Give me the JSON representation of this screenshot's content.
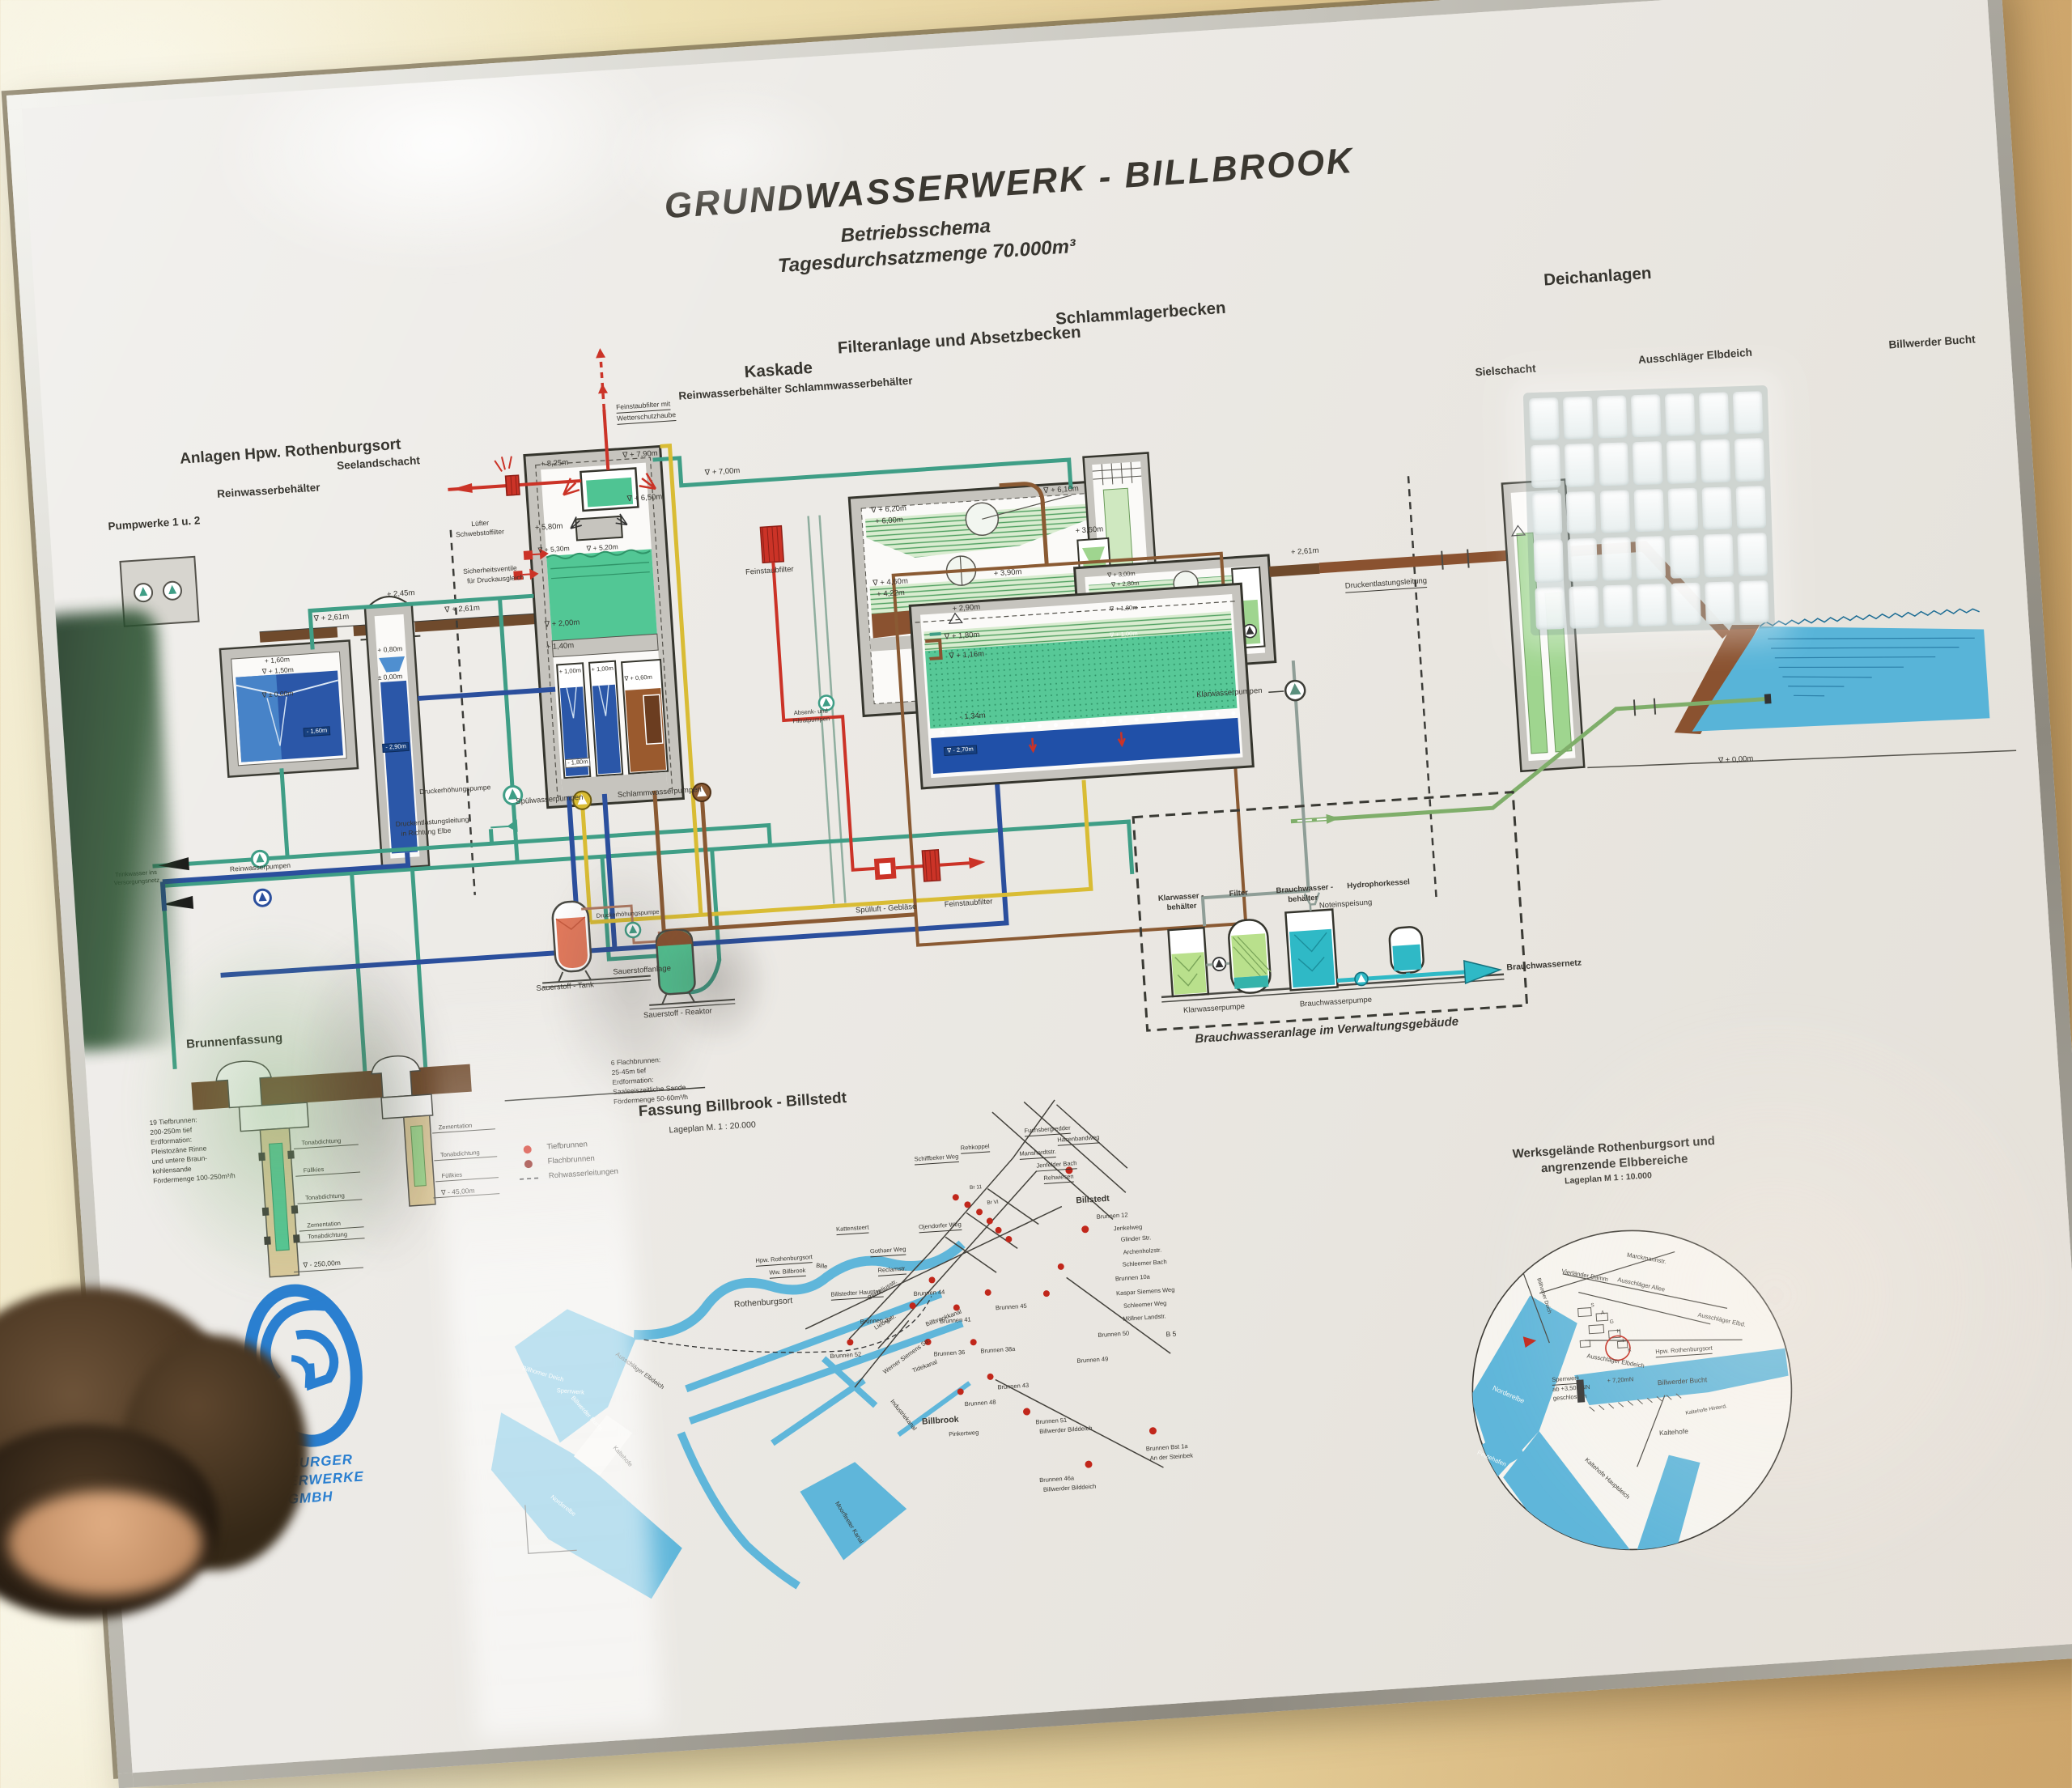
{
  "title": {
    "main": "GRUNDWASSERWERK - BILLBROOK",
    "sub1": "Betriebsschema",
    "sub2": "Tagesdurchsatzmenge 70.000m³"
  },
  "sections": {
    "anlagen": "Anlagen Hpw. Rothenburgsort",
    "pumpwerke": "Pumpwerke 1 u. 2",
    "reinwasser": "Reinwasserbehälter",
    "seeland": "Seelandschacht",
    "kaskade": "Kaskade",
    "kaskade_sub": "Reinwasserbehälter   Schlammwasserbehälter",
    "filteranlage": "Filteranlage und Absetzbecken",
    "schlamm": "Schlammlagerbecken",
    "deich": "Deichanlagen",
    "siel": "Sielschacht",
    "ausschlaeger": "Ausschläger Elbdeich",
    "billwerder": "Billwerder Bucht",
    "brunnen": "Brunnenfassung"
  },
  "labels": {
    "luefter": "Lüfter",
    "schwebstoff": "Schwebstoffilter",
    "feinstaub_mit": "Feinstaubfilter mit",
    "wetterschutz": "Wetterschutzhaube",
    "sicherheitsventile": "Sicherheitsventile",
    "druckausgleich": "für Druckausgleich",
    "feinstaubfilter": "Feinstaubfilter",
    "absenk": "Absenk- und",
    "filtratpumpen": "Filtratpumpen",
    "spuelwasserpumpen": "Spülwasserpumpen",
    "schlammwasserpumpen": "Schlammwasserpumpen",
    "druckerhoehung": "Druckerhöhungspumpe",
    "druckentlastung": "Druckentlastungsleitung",
    "richtung_elbe": "in Richtung Elbe",
    "trinkwasser1": "Trinkwasser ins",
    "trinkwasser2": "Versorgungsnetz",
    "reinwasserpumpen": "Reinwasserpumpen",
    "sauerstoff_tank": "Sauerstoff - Tank",
    "sauerstoffanlage": "Sauerstoffanlage",
    "sauerstoff_reaktor": "Sauerstoff - Reaktor",
    "spuelluft": "Spülluft - Gebläse",
    "klarwasserpumpen": "Klarwasserpumpen"
  },
  "levels": {
    "l825": "+ 8,25m",
    "l790": "∇ + 7,90m",
    "l700": "∇ + 7,00m",
    "l650": "∇ + 6,50m",
    "l580": "+ 5,80m",
    "l530": "∇ + 5,30m",
    "l520": "∇ + 5,20m",
    "l200": "∇ + 2,00m",
    "l140": "+ 1,40m",
    "l100a": "+ 1,00m",
    "l100b": "+ 1,00m",
    "l060": "∇ + 0,60m",
    "lm180": "- 1,80m",
    "l620": "∇ + 6,20m",
    "l600": "+ 6,00m",
    "l460": "∇ + 4,60m",
    "l422": "+ 4,22m",
    "l390": "+ 3,90m",
    "l610": "∇ + 6,10m",
    "l290": "+ 2,90m",
    "l180": "∇ + 1,80m",
    "l116": "∇ + 1,16m",
    "lm134": "- 1,34m",
    "lm270": "∇ - 2,70m",
    "l360": "+ 3,60m",
    "l300": "∇ + 3,00m",
    "l280": "∇ + 2,80m",
    "l180b": "∇ + 1,80m",
    "l100c": "∇ + 1,00m",
    "l261a": "∇ + 2,61m",
    "l261b": "∇ + 2,61m",
    "l261c": "+ 2,61m",
    "l245": "+ 2,45m",
    "l160": "+ 1,60m",
    "l150": "∇ + 1,50m",
    "l000a": "∇ ± 0,00m",
    "lm160": "- 1,60m",
    "l080": "+ 0,80m",
    "l000b": "± 0,00m",
    "lm290": "- 2,90m",
    "l000c": "∇ ± 0,00m"
  },
  "brauchwasser": {
    "klarwasser1": "Klarwasser -",
    "klarwasser2": "behälter",
    "filter": "Filter",
    "brauch1": "Brauchwasser -",
    "brauch2": "behälter",
    "hydrophor": "Hydrophorkessel",
    "noteinspeisung": "Noteinspeisung",
    "klarwasserpumpe": "Klarwasserpumpe",
    "brauchwasserpumpe": "Brauchwasserpumpe",
    "brauchwassernetz": "Brauchwassernetz",
    "caption": "Brauchwasseranlage im Verwaltungsgebäude"
  },
  "wells": {
    "tief1": "19 Tiefbrunnen:",
    "tief2": "200-250m tief",
    "tief3": "Erdformation:",
    "tief4": "Pleistozäne Rinne",
    "tief5": "und untere Braun-",
    "tief6": "kohlensande",
    "tief7": "Fördermenge 100-250m³/h",
    "flach1": "6 Flachbrunnen:",
    "flach2": "25-45m tief",
    "flach3": "Erdformation:",
    "flach4": "Saaleeiszeitliche Sande",
    "flach5": "Fördermenge 50-60m³/h",
    "ton": "Tonabdichtung",
    "fuellkies": "Füllkies",
    "zement": "Zementation",
    "d250": "∇ - 250,00m",
    "d45": "∇ - 45,00m"
  },
  "map1": {
    "title": "Fassung Billbrook - Billstedt",
    "scale": "Lageplan  M. 1 : 20.000",
    "leg1": "Tiefbrunnen",
    "leg2": "Flachbrunnen",
    "leg3": "Rohwasserleitungen",
    "streets": {
      "rehkoppel": "Rehkoppel",
      "fuchsberg": "Fuchsbergredder",
      "hasenband": "Hasenbandweg",
      "schiffbeker": "Schiffbeker Weg",
      "manshardt": "Manshardtstr.",
      "jenfelder": "Jenfelder Bach",
      "rehwiesen": "Rehwiesen",
      "billstedt": "Billstedt",
      "kattensteert": "Kattensteert",
      "ojendorfer": "Ojendorfer Weg",
      "gothaer": "Gothaer Weg",
      "reclam": "Reclamstr.",
      "hauptstr": "Billstedter Hauptstr.",
      "jenkel": "Jenkelweg",
      "glinder": "Glinder Str.",
      "archenholz": "Archenholzstr.",
      "schleemerbach": "Schleemer Bach",
      "kaspar": "Kaspar Siemens Weg",
      "schleemerweg": "Schleemer Weg",
      "moellner": "Möllner Landstr.",
      "b5": "B 5",
      "rothenburgsort": "Rothenburgsort",
      "billbrook": "Billbrook",
      "hpw": "Hpw. Rothenburgsort",
      "ww": "Ww. Billbrook",
      "berzelius": "Berzeliusstr.",
      "liebig": "Liebigstr.",
      "werner": "Werner Siemens Str.",
      "billbrookkanal": "Billbrookkanal",
      "tidekanal": "Tidekanal",
      "industriekanal": "Industriekanal",
      "moorfleeter": "Moorfleeter Kanal",
      "bille": "Bille",
      "pinkert": "Pinkertweg",
      "billwerderbucht": "Billwerder Bucht",
      "kaltehofe": "Kaltehofe",
      "norderelbe": "Norderelbe",
      "sperrwerk": "Sperrwerk",
      "ausschlaeger": "Ausschläger Elbdeich",
      "billhorner": "Billhorner Deich",
      "br11": "Br 11",
      "brvi": "Br VI"
    },
    "wellsm": {
      "b12": "Brunnen 12",
      "b10a": "Brunnen 10a",
      "b50": "Brunnen 50",
      "b49": "Brunnen 49",
      "b45": "Brunnen 45",
      "b44": "Brunnen 44",
      "b41": "Brunnen 41",
      "b37": "Brunnen 37",
      "b52": "Brunnen 52",
      "b36": "Brunnen 36",
      "b38a": "Brunnen 38a",
      "b43": "Brunnen 43",
      "b48": "Brunnen 48",
      "b51": "Brunnen 51",
      "b51b": "Billwerder Bilddeich",
      "b46a": "Brunnen 46a",
      "b46b": "Billwerder Bilddeich",
      "bst1": "Brunnen Bst 1a",
      "bst2": "An der Steinbek"
    }
  },
  "map2": {
    "t1": "Werksgelände Rothenburgsort  und",
    "t2": "angrenzende Elbbereiche",
    "t3": "Lageplan  M 1 : 10.000",
    "marckmann": "Marckmannstr.",
    "vierlaender": "Vierländer Damm",
    "allee": "Ausschläger Allee",
    "elbd": "Ausschläger Elbd.",
    "elbdeich": "Ausschläger Elbdeich",
    "billhorner": "Billhorner Deich",
    "hpw": "Hpw. Rothenburgsort",
    "sperrwerk1": "Sperrwerk",
    "sperrwerk2": "ab +3,50mNN",
    "sperrwerk3": "geschlossen",
    "mn720": "+ 7,20mN",
    "bucht": "Billwerder Bucht",
    "norderelbe": "Norderelbe",
    "peutehafen": "Peutehafen",
    "kaltehofe": "Kaltehofe",
    "hauptdeich": "Kaltehofe Hauptdeich",
    "hinterdeich": "Kaltehofe Hinterd.",
    "letters": [
      "S",
      "A",
      "G",
      "H",
      "I",
      "K"
    ]
  },
  "logo": {
    "l1": "HAMBURGER",
    "l2": "WASSERWERKE",
    "l3": "GMBH"
  }
}
